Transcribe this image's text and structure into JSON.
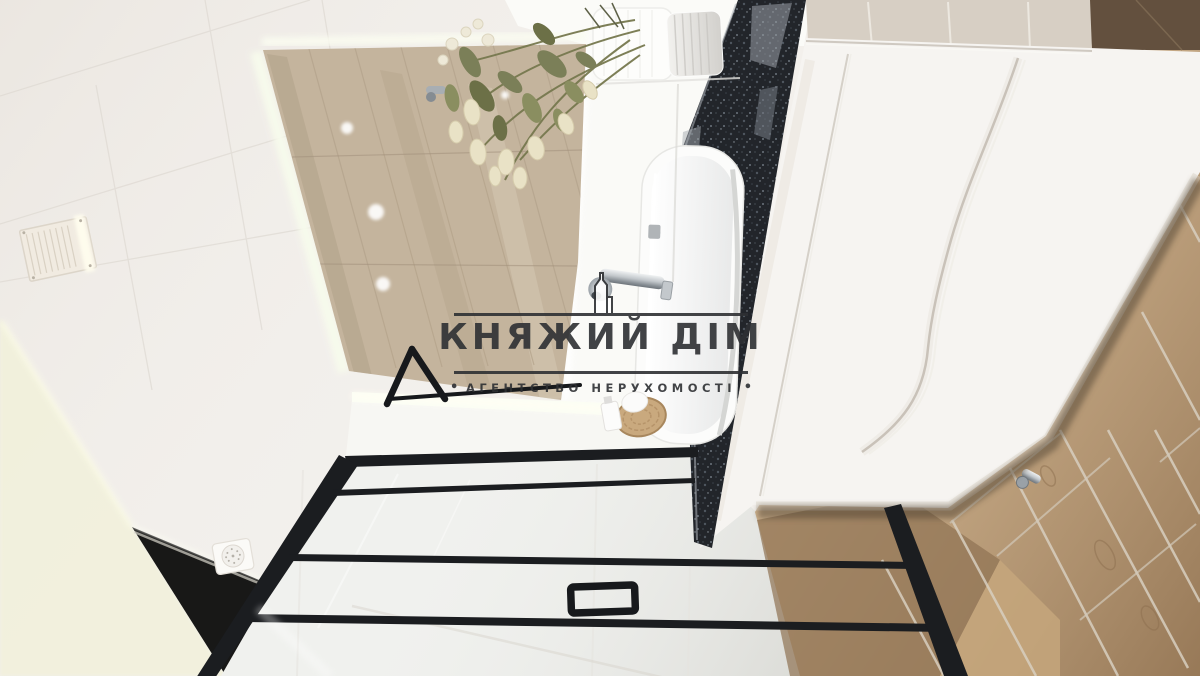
{
  "photo": {
    "description": "Interior photo of a modern bathroom, rotated sideways, used as a real-estate listing image"
  },
  "watermark": {
    "title": "КНЯЖИЙ ДІМ",
    "subtitle": "АГЕНТСТВО НЕРУХОМОСТІ",
    "bullet_left": "•",
    "bullet_right": "•",
    "ink": "#2e3033"
  },
  "palette": {
    "ceiling": "#f2efeb",
    "far_wall_glow": "#f2f1dc",
    "mirror_wall": "#fbfbf8",
    "under_mirror_wall": "#f7f7f3",
    "glass": "#f0f1ee",
    "led_glow": "#fbfdf4",
    "wood_wall": "#c4b49d",
    "floor_wood": "#c0a079",
    "floor_dark": "#63503e",
    "beige_wall": "#d7cfc4",
    "granite": "#22252a",
    "vanity": "#f6f4f1",
    "frame_black": "#1b1d20",
    "chrome": "#aab0b6",
    "towel_white": "#fcfcfb",
    "flower_leaf": "#7b7f58",
    "flower_bud": "#e9e2c6",
    "basket_tan": "#c9a97e"
  }
}
